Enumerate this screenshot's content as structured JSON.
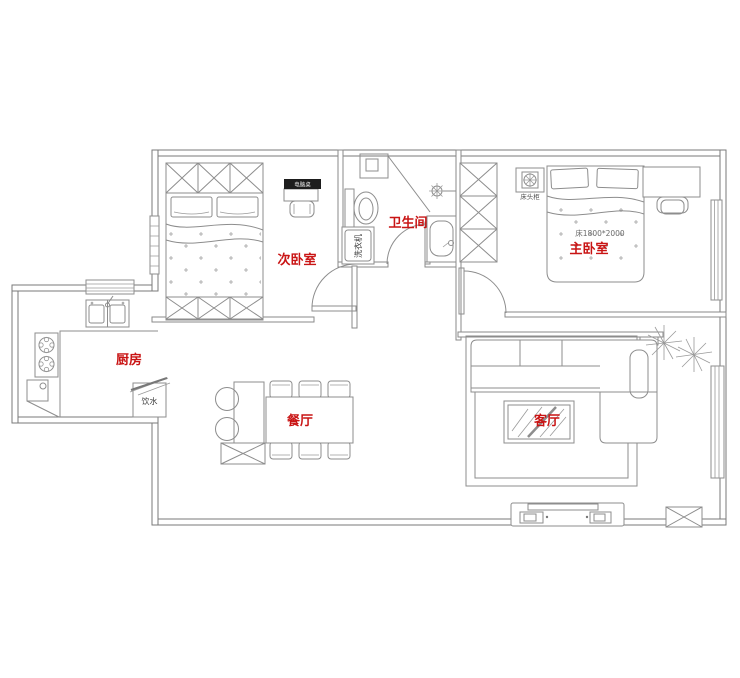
{
  "floor_plan": {
    "room_labels": {
      "secondary_bedroom": "次卧室",
      "bathroom": "卫生间",
      "master_bedroom": "主卧室",
      "kitchen": "厨房",
      "dining_room": "餐厅",
      "living_room": "客厅"
    },
    "annotations": {
      "bed_size": "床1800*2000",
      "washing_machine": "洗衣机",
      "water_dispenser": "饮水",
      "nightstand": "床头柜",
      "desk_tag": "电脑桌"
    },
    "colors": {
      "room_label": "#c91414",
      "wall_line": "#7a7a7a",
      "furniture_line": "#8d8d8d",
      "annotation_text": "#4a4a4a"
    }
  }
}
